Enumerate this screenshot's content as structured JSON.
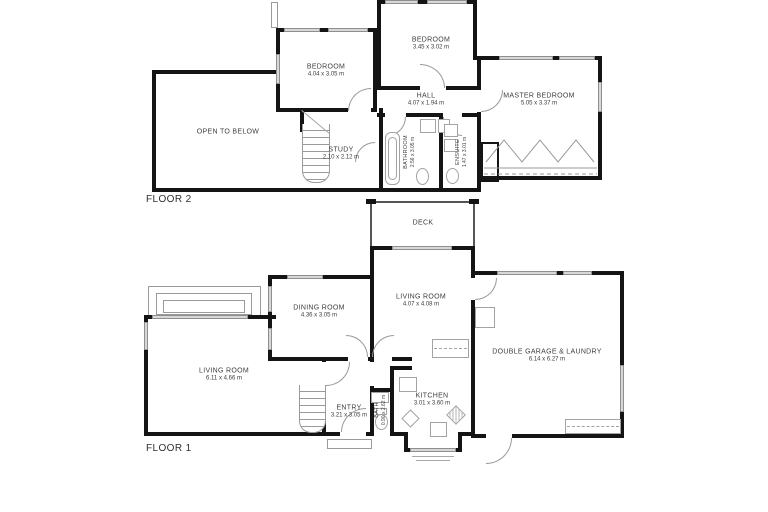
{
  "colors": {
    "wall": "#141414",
    "window_fill": "#d8d8d8",
    "fixture_line": "#9a9a9a",
    "text": "#3d3d3d",
    "background": "#ffffff"
  },
  "floor2": {
    "label": "FLOOR 2",
    "rooms": {
      "open_to_below": {
        "name": "OPEN TO BELOW",
        "dims": ""
      },
      "bedroom_left": {
        "name": "BEDROOM",
        "dims": "4.04 x 3.05 m"
      },
      "bedroom_top": {
        "name": "BEDROOM",
        "dims": "3.45 x 3.02 m"
      },
      "master_bedroom": {
        "name": "MASTER BEDROOM",
        "dims": "5.05 x 3.37 m"
      },
      "hall": {
        "name": "HALL",
        "dims": "4.07 x 1.94 m"
      },
      "study": {
        "name": "STUDY",
        "dims": "2.10 x 2.12 m"
      },
      "bathroom": {
        "name": "BATHROOM",
        "dims": "2.56 x 3.05 m"
      },
      "ensuite": {
        "name": "ENSUITE",
        "dims": "1.47 x 3.01 m"
      }
    }
  },
  "floor1": {
    "label": "FLOOR 1",
    "rooms": {
      "living_room_main": {
        "name": "LIVING ROOM",
        "dims": "6.11 x 4.66 m"
      },
      "dining_room": {
        "name": "DINING ROOM",
        "dims": "4.36 x 3.05 m"
      },
      "living_room_small": {
        "name": "LIVING ROOM",
        "dims": "4.07 x 4.08 m"
      },
      "deck": {
        "name": "DECK",
        "dims": ""
      },
      "garage": {
        "name": "DOUBLE GARAGE & LAUNDRY",
        "dims": "6.14 x 6.27 m"
      },
      "entry": {
        "name": "ENTRY",
        "dims": "3.21 x 3.05 m"
      },
      "bath": {
        "name": "BATH",
        "dims": "0.90 x 2.62 m"
      },
      "kitchen": {
        "name": "KITCHEN",
        "dims": "3.01 x 3.60 m"
      }
    }
  }
}
